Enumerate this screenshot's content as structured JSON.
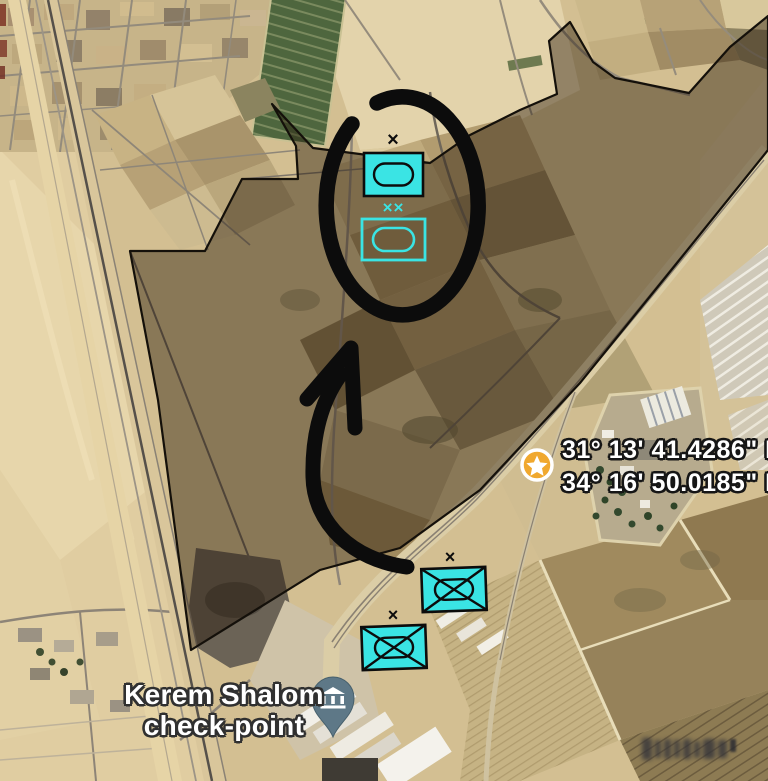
{
  "theme": {
    "cyan": "#3ae4e4",
    "ink": "#0c0c0c",
    "star-gold": "#f0a82e",
    "pin-slate": "#5e7887",
    "label-white": "#ffffff"
  },
  "map": {
    "place_label": {
      "line1": "Kerem Shalom",
      "line2": "check-point"
    },
    "coordinates": {
      "latitude": "31° 13' 41.4286\" N",
      "longitude": "34° 16' 50.0185\" E"
    },
    "units": {
      "armor_north": {
        "symbol": "armor-unit-filled",
        "echelon": "×"
      },
      "armor_division": {
        "symbol": "armor-unit-outline",
        "echelon": "××"
      },
      "mech_infantry_east": {
        "symbol": "mechanized-infantry-filled",
        "echelon": "×"
      },
      "mech_infantry_west": {
        "symbol": "mechanized-infantry-filled",
        "echelon": "×"
      }
    }
  }
}
